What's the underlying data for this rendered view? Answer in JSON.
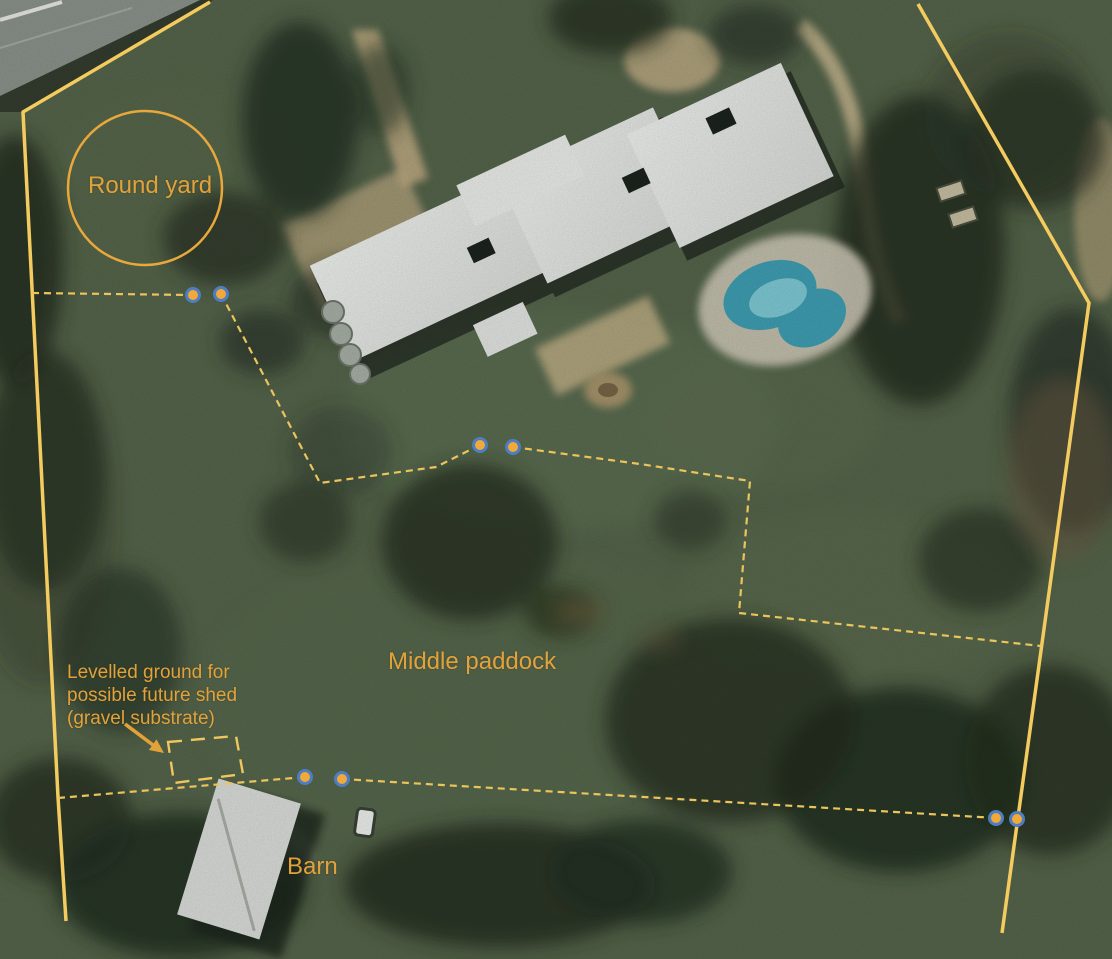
{
  "map": {
    "type": "aerial-property-annotation",
    "labels": {
      "round_yard": "Round yard",
      "middle_paddock": "Middle paddock",
      "barn": "Barn",
      "shed_note": {
        "line1": "Levelled ground for",
        "line2": "possible future shed",
        "line3": "(gravel substrate)"
      }
    },
    "annotation_colors": {
      "label_text": "#E2A23A",
      "boundary_solid": "#F4CB5E",
      "fence_dashed": "#ECC45C",
      "shed_rectangle_dashed": "#EFC75E",
      "gate_dot_fill": "#F1A93A",
      "gate_dot_ring": "#4E7EC1",
      "arrow": "#E2A23A",
      "round_yard_circle": "#E8A83C"
    },
    "overlay_features": {
      "boundary_lines": 2,
      "fence_lines": 2,
      "gate_marker_pairs": 4,
      "gate_markers_total": 8,
      "shed_site_rectangle": 1,
      "round_yard_circle": 1,
      "pointer_arrow": 1
    }
  }
}
